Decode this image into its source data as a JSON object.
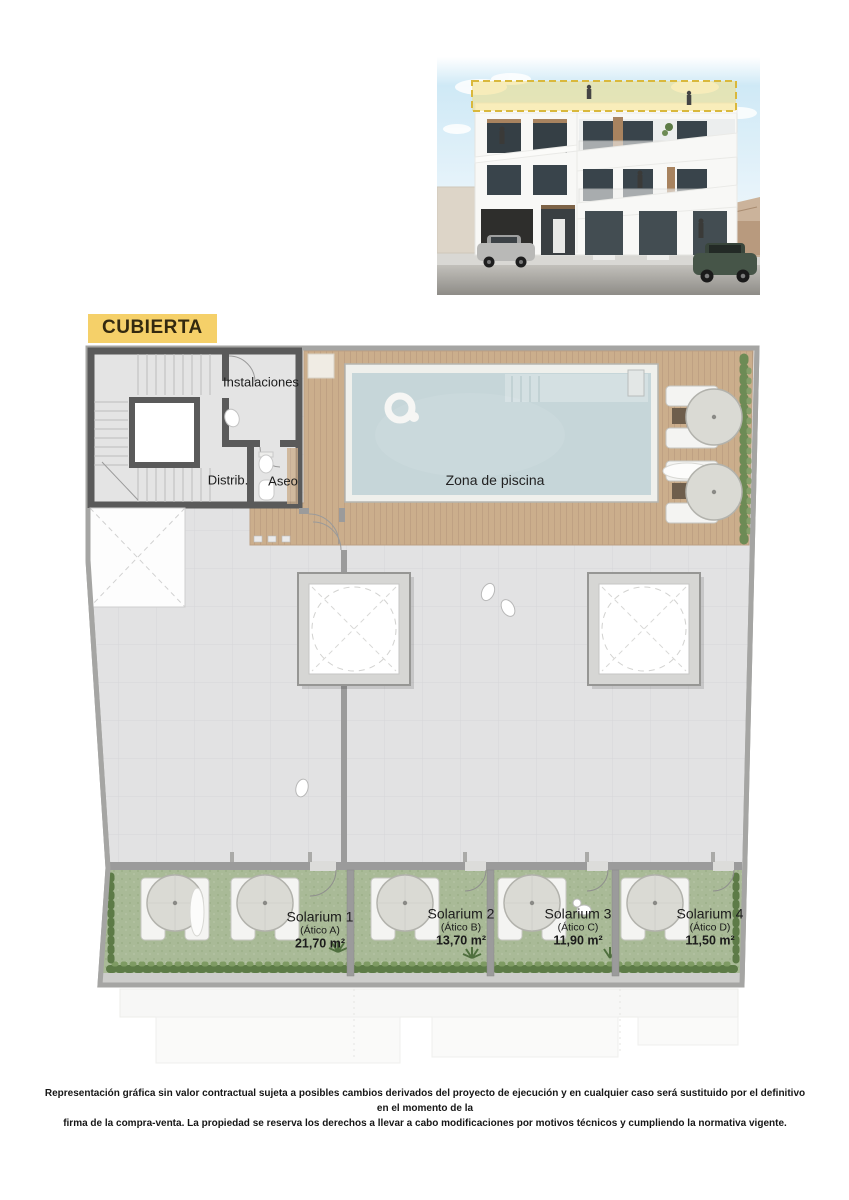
{
  "title": {
    "label": "CUBIERTA"
  },
  "plan": {
    "rooms": {
      "instalaciones": "Instalaciones",
      "distribuidor": "Distrib.",
      "aseo": "Aseo",
      "pool_zone": "Zona de piscina"
    },
    "solariums": [
      {
        "name": "Solarium 1",
        "unit": "(Ático A)",
        "area": "21,70 m²"
      },
      {
        "name": "Solarium 2",
        "unit": "(Ático B)",
        "area": "13,70 m²"
      },
      {
        "name": "Solarium 3",
        "unit": "(Ático C)",
        "area": "11,90 m²"
      },
      {
        "name": "Solarium 4",
        "unit": "(Ático D)",
        "area": "11,50 m²"
      }
    ]
  },
  "disclaimer": {
    "line1": "Representación gráfica sin valor contractual sujeta a posibles cambios derivados del proyecto de ejecución y en cualquier caso será sustituido por el definitivo en el momento de la",
    "line2": "firma de la compra-venta. La propiedad se reserva los derechos a llevar a cabo modificaciones por motivos técnicos y cumpliendo la normativa vigente."
  },
  "colors": {
    "highlight_yellow": "#f5d069",
    "pool_water": "#c6d6d9",
    "wood_deck": "#cbae8c",
    "solarium_grass": "#a9ba97",
    "core_wall_dark": "#5a5a5a",
    "parapet_gray": "#a5a5a3"
  }
}
